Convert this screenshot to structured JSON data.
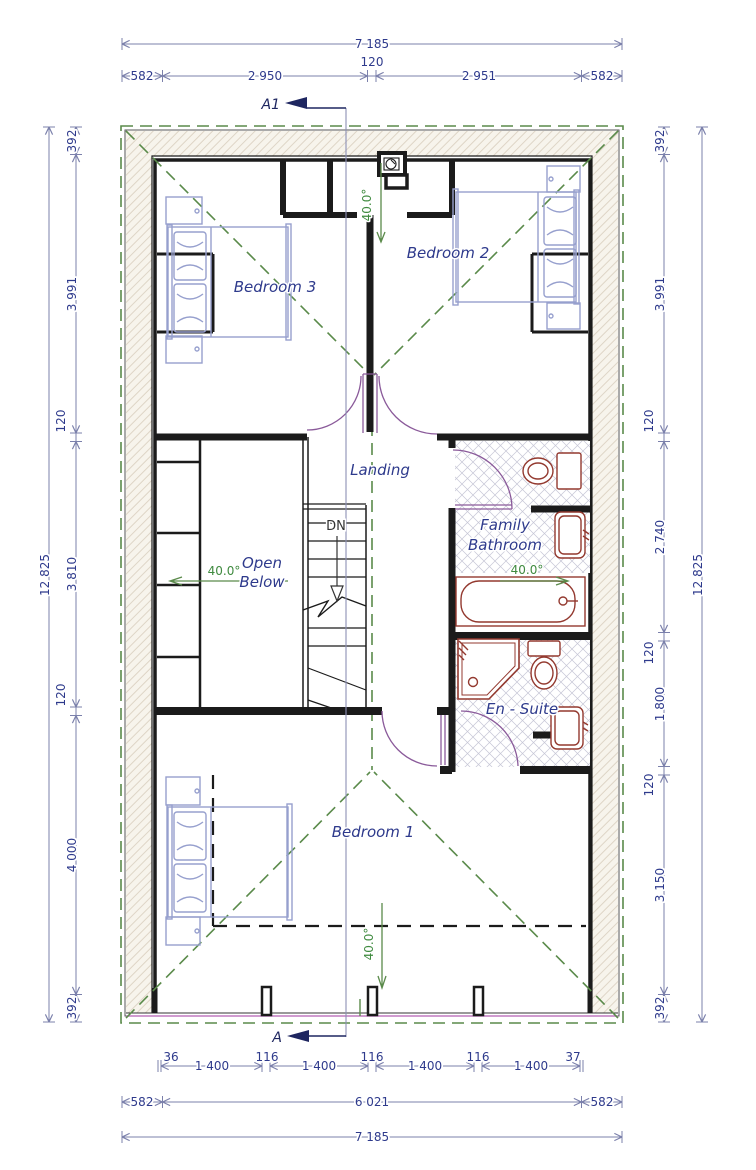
{
  "colors": {
    "wall": "#1b1b1b",
    "roof_lines_green": "#5a8a4a",
    "doors_purple": "#8a5a9a",
    "fixtures_red": "#93392f",
    "furniture_blue": "#97a0ce",
    "dimension_navy": "#2e3a8c",
    "tile_gray": "#c6c6d6",
    "wall_hatch_tan": "#dcd2c2",
    "eaves_magenta": "#c07ac0",
    "section_line_gray": "#8d90b5"
  },
  "dims": {
    "top_overall": "7 185",
    "top_row": [
      "582",
      "2 950",
      "120",
      "2 951",
      "582"
    ],
    "bottom_row1": [
      "36",
      "1 400",
      "116",
      "1 400",
      "116",
      "1 400",
      "116",
      "1 400",
      "37"
    ],
    "bottom_row2": [
      "582",
      "6 021",
      "582"
    ],
    "bottom_overall": "7 185",
    "left_row": [
      "392",
      "3 991",
      "120",
      "3 810",
      "120",
      "4 000",
      "392"
    ],
    "left_overall": "12 825",
    "right_row": [
      "392",
      "3 991",
      "120",
      "2 740",
      "120",
      "1 800",
      "120",
      "3 150",
      "392"
    ],
    "right_overall": "12 825"
  },
  "rooms": {
    "bedroom3": "Bedroom 3",
    "bedroom2": "Bedroom 2",
    "bedroom1": "Bedroom 1",
    "landing": "Landing",
    "family_bathroom": [
      "Family",
      "Bathroom"
    ],
    "open_below": [
      "Open",
      "Below"
    ],
    "ensuite": "En - Suite"
  },
  "annotations": {
    "stairs": "DN",
    "pitch": "40.0°",
    "section_top": "A1",
    "section_bottom": "A"
  }
}
